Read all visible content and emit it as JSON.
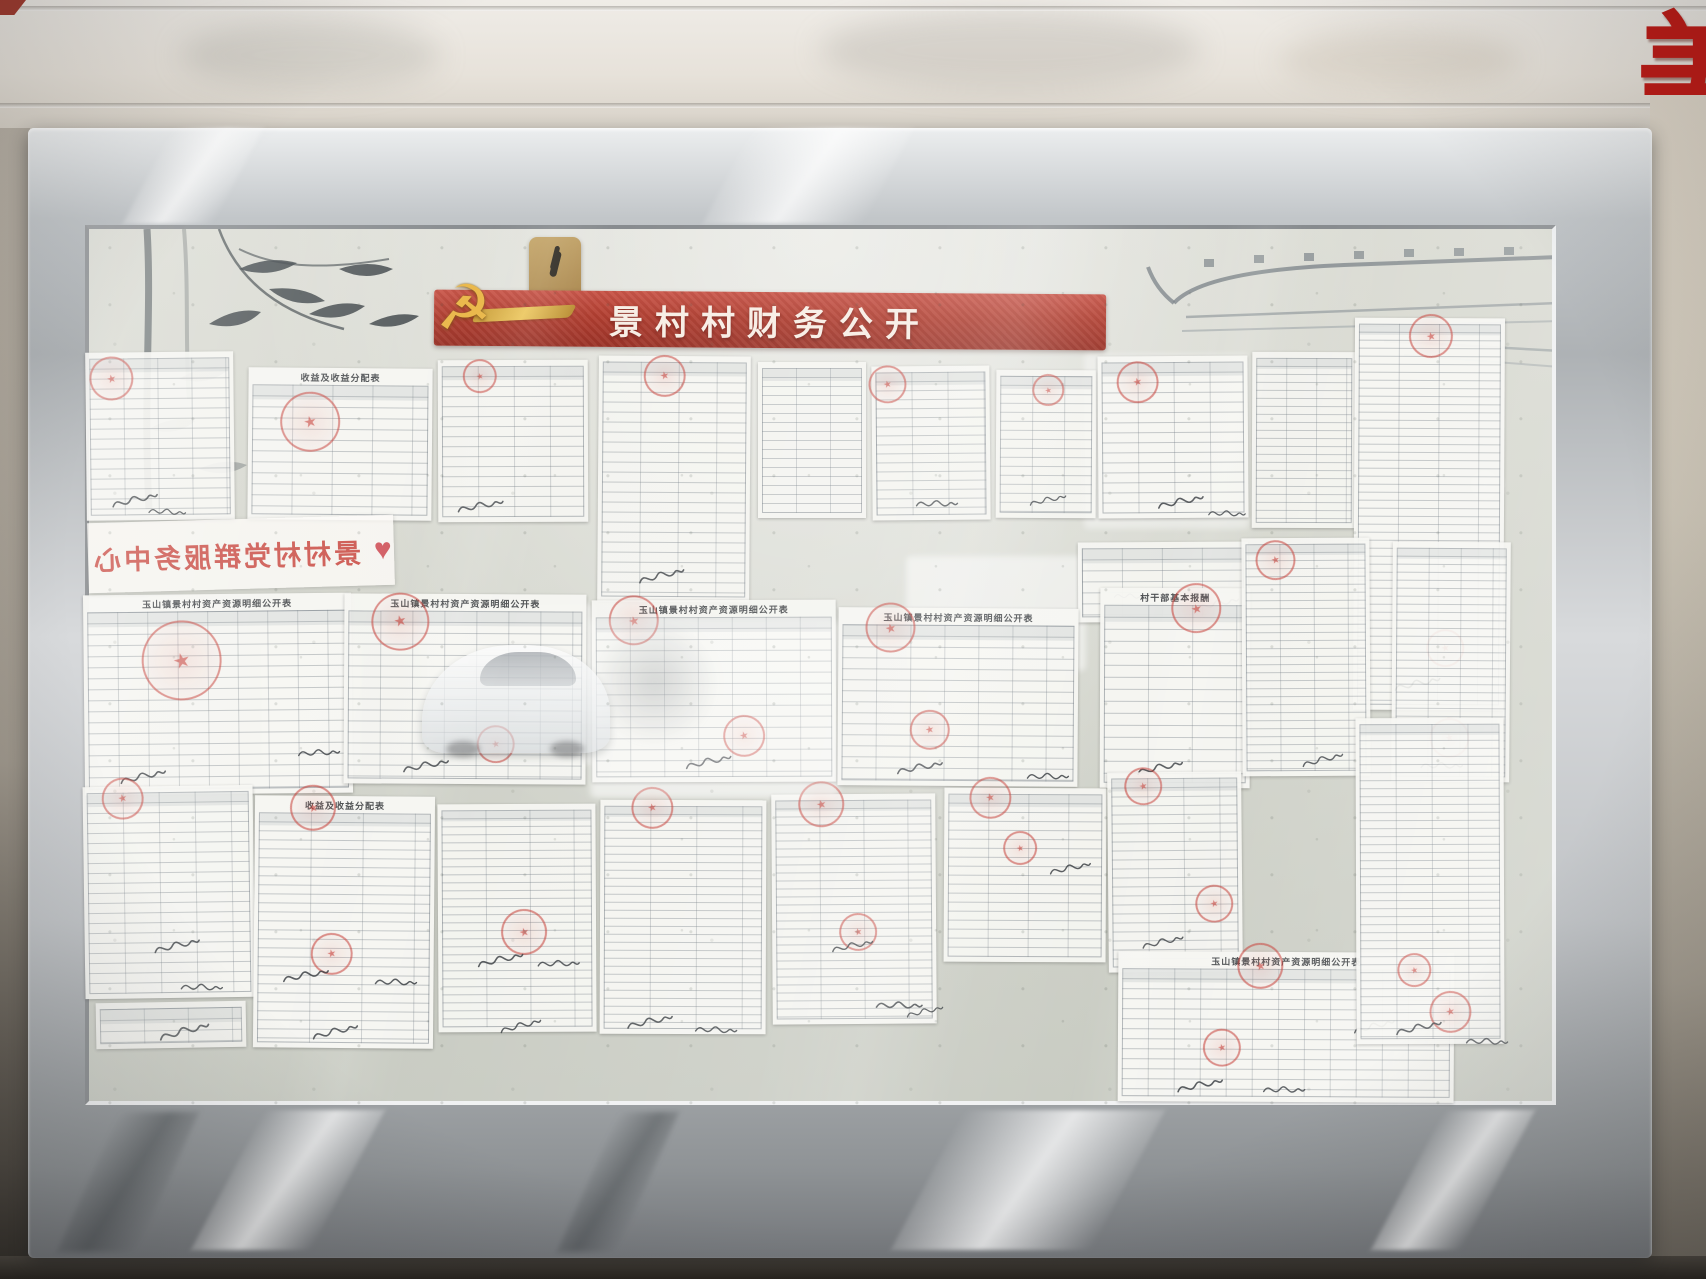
{
  "scene": {
    "banner_title": "景村村财务公开",
    "service_center_text": "景村村党群服务中心",
    "corner_sign_char": "美"
  },
  "colors": {
    "banner_red": "#b03a2c",
    "stamp_red": "#c32d26",
    "emblem_gold": "#e9b646",
    "frame_silver": "#c6c9cb",
    "glass_tint": "#d6d8cf"
  },
  "documents": [
    {
      "x": 86,
      "y": 352,
      "w": 148,
      "h": 168,
      "rot": -0.6,
      "rh": 10,
      "cw": 34,
      "op": 0.92,
      "title": "",
      "stamps": [
        [
          26,
          26,
          22
        ]
      ],
      "sigs": [
        [
          24,
          138,
          1,
          -6
        ],
        [
          56,
          150,
          0.8,
          10
        ]
      ]
    },
    {
      "x": 248,
      "y": 368,
      "w": 184,
      "h": 152,
      "rot": 0.5,
      "rh": 11,
      "cw": 40,
      "op": 0.95,
      "title": "收益及收益分配表",
      "stamps": [
        [
          62,
          54,
          30
        ]
      ],
      "sigs": []
    },
    {
      "x": 438,
      "y": 360,
      "w": 150,
      "h": 162,
      "rot": -0.2,
      "rh": 10,
      "cw": 36,
      "op": 0.9,
      "title": "",
      "stamps": [
        [
          42,
          16,
          17
        ]
      ],
      "sigs": [
        [
          18,
          136,
          1,
          -4
        ]
      ]
    },
    {
      "x": 598,
      "y": 356,
      "w": 152,
      "h": 246,
      "rot": 0.4,
      "rh": 10,
      "cw": 38,
      "op": 0.9,
      "title": "",
      "stamps": [
        [
          66,
          20,
          21
        ]
      ],
      "sigs": [
        [
          40,
          210,
          1,
          -8
        ]
      ]
    },
    {
      "x": 758,
      "y": 362,
      "w": 108,
      "h": 156,
      "rot": 0,
      "rh": 9,
      "cw": 34,
      "op": 0.88,
      "title": "",
      "stamps": [],
      "sigs": []
    },
    {
      "x": 872,
      "y": 366,
      "w": 118,
      "h": 154,
      "rot": -0.5,
      "rh": 9,
      "cw": 36,
      "op": 0.9,
      "title": "",
      "stamps": [
        [
          16,
          18,
          19
        ]
      ],
      "sigs": [
        [
          40,
          128,
          0.9,
          6
        ]
      ]
    },
    {
      "x": 996,
      "y": 370,
      "w": 100,
      "h": 148,
      "rot": 0.3,
      "rh": 9,
      "cw": 32,
      "op": 0.88,
      "title": "",
      "stamps": [
        [
          52,
          20,
          16
        ]
      ],
      "sigs": [
        [
          28,
          120,
          0.8,
          -6
        ]
      ]
    },
    {
      "x": 1098,
      "y": 356,
      "w": 150,
      "h": 162,
      "rot": -0.4,
      "rh": 10,
      "cw": 36,
      "op": 0.93,
      "title": "",
      "stamps": [
        [
          40,
          26,
          21
        ]
      ],
      "sigs": [
        [
          58,
          136,
          1,
          -5
        ],
        [
          104,
          148,
          0.8,
          8
        ]
      ]
    },
    {
      "x": 1252,
      "y": 352,
      "w": 104,
      "h": 176,
      "rot": 0.2,
      "rh": 8,
      "cw": 30,
      "op": 0.88,
      "title": "",
      "stamps": [],
      "sigs": []
    },
    {
      "x": 1354,
      "y": 318,
      "w": 150,
      "h": 392,
      "rot": 0.3,
      "rh": 8,
      "cw": 40,
      "op": 0.95,
      "title": "",
      "stamps": [
        [
          76,
          18,
          22
        ],
        [
          92,
          330,
          19
        ]
      ],
      "sigs": [
        [
          40,
          356,
          1,
          -6
        ]
      ]
    },
    {
      "x": 1078,
      "y": 542,
      "w": 170,
      "h": 80,
      "rot": -0.3,
      "rh": 11,
      "cw": 40,
      "op": 0.9,
      "title": "",
      "stamps": [],
      "sigs": [
        [
          116,
          52,
          0.9,
          -5
        ],
        [
          28,
          44,
          0.7,
          8
        ]
      ]
    },
    {
      "x": 1100,
      "y": 588,
      "w": 150,
      "h": 200,
      "rot": 0.2,
      "rh": 12,
      "cw": 44,
      "op": 0.96,
      "title": "村干部基本报酬",
      "stamps": [
        [
          96,
          20,
          25
        ]
      ],
      "sigs": [
        [
          36,
          170,
          1,
          -6
        ]
      ]
    },
    {
      "x": 1242,
      "y": 538,
      "w": 128,
      "h": 238,
      "rot": -0.3,
      "rh": 8,
      "cw": 34,
      "op": 0.92,
      "title": "",
      "stamps": [
        [
          34,
          22,
          20
        ]
      ],
      "sigs": [
        [
          56,
          212,
          0.9,
          -8
        ]
      ]
    },
    {
      "x": 1392,
      "y": 542,
      "w": 118,
      "h": 240,
      "rot": 0.4,
      "rh": 8,
      "cw": 32,
      "op": 0.9,
      "title": "",
      "stamps": [
        [
          58,
          196,
          20
        ]
      ],
      "sigs": [
        [
          26,
          214,
          0.9,
          6
        ]
      ]
    },
    {
      "x": 84,
      "y": 594,
      "w": 268,
      "h": 200,
      "rot": -0.6,
      "rh": 11,
      "cw": 30,
      "op": 0.96,
      "title": "玉山镇景村村资产资源明细公开表",
      "stamps": [
        [
          98,
          66,
          40
        ]
      ],
      "sigs": [
        [
          34,
          172,
          1,
          -6
        ],
        [
          210,
          150,
          0.9,
          4
        ]
      ]
    },
    {
      "x": 344,
      "y": 594,
      "w": 242,
      "h": 190,
      "rot": 0.3,
      "rh": 11,
      "cw": 32,
      "op": 0.94,
      "title": "玉山镇景村村资产资源明细公开表",
      "stamps": [
        [
          56,
          28,
          29
        ],
        [
          152,
          150,
          19
        ]
      ],
      "sigs": [
        [
          58,
          162,
          1,
          -5
        ]
      ]
    },
    {
      "x": 592,
      "y": 600,
      "w": 244,
      "h": 182,
      "rot": -0.2,
      "rh": 11,
      "cw": 34,
      "op": 0.92,
      "title": "玉山镇景村村资产资源明细公开表",
      "stamps": [
        [
          42,
          20,
          25
        ],
        [
          152,
          136,
          21
        ]
      ],
      "sigs": [
        [
          92,
          152,
          1,
          -6
        ]
      ]
    },
    {
      "x": 838,
      "y": 608,
      "w": 240,
      "h": 178,
      "rot": 0.4,
      "rh": 11,
      "cw": 34,
      "op": 0.94,
      "title": "玉山镇景村村资产资源明细公开表",
      "stamps": [
        [
          52,
          20,
          25
        ],
        [
          92,
          122,
          20
        ]
      ],
      "sigs": [
        [
          58,
          150,
          1,
          -5
        ],
        [
          186,
          158,
          0.9,
          6
        ]
      ]
    },
    {
      "x": 84,
      "y": 786,
      "w": 170,
      "h": 212,
      "rot": -0.8,
      "rh": 10,
      "cw": 36,
      "op": 0.95,
      "title": "",
      "stamps": [
        [
          40,
          12,
          21
        ]
      ],
      "sigs": [
        [
          68,
          150,
          1,
          -6
        ],
        [
          92,
          192,
          0.9,
          8
        ]
      ]
    },
    {
      "x": 96,
      "y": 1002,
      "w": 150,
      "h": 46,
      "rot": -1,
      "rh": 11,
      "cw": 44,
      "op": 0.85,
      "title": "",
      "stamps": [],
      "sigs": [
        [
          64,
          20,
          1.1,
          -8
        ]
      ]
    },
    {
      "x": 254,
      "y": 796,
      "w": 180,
      "h": 252,
      "rot": 0.5,
      "rh": 9,
      "cw": 52,
      "op": 0.97,
      "title": "收益及收益分配表",
      "stamps": [
        [
          58,
          12,
          23
        ],
        [
          78,
          158,
          21
        ]
      ],
      "sigs": [
        [
          28,
          170,
          1,
          -5
        ],
        [
          118,
          176,
          0.9,
          7
        ],
        [
          58,
          226,
          1,
          -8
        ]
      ]
    },
    {
      "x": 438,
      "y": 804,
      "w": 158,
      "h": 228,
      "rot": -0.3,
      "rh": 8,
      "cw": 44,
      "op": 0.93,
      "title": "",
      "stamps": [
        [
          86,
          128,
          23
        ]
      ],
      "sigs": [
        [
          38,
          146,
          1,
          -6
        ],
        [
          96,
          150,
          0.9,
          5
        ],
        [
          58,
          212,
          0.9,
          -8
        ]
      ]
    },
    {
      "x": 600,
      "y": 800,
      "w": 166,
      "h": 234,
      "rot": 0.2,
      "rh": 8,
      "cw": 46,
      "op": 0.94,
      "title": "",
      "stamps": [
        [
          52,
          8,
          21
        ]
      ],
      "sigs": [
        [
          26,
          212,
          1,
          -6
        ],
        [
          92,
          220,
          0.9,
          8
        ]
      ]
    },
    {
      "x": 772,
      "y": 794,
      "w": 164,
      "h": 230,
      "rot": -0.4,
      "rh": 8,
      "cw": 44,
      "op": 0.94,
      "title": "",
      "stamps": [
        [
          50,
          10,
          23
        ],
        [
          86,
          138,
          19
        ]
      ],
      "sigs": [
        [
          56,
          142,
          0.9,
          -5
        ],
        [
          102,
          202,
          1,
          7
        ],
        [
          128,
          208,
          0.8,
          -6
        ]
      ]
    },
    {
      "x": 944,
      "y": 788,
      "w": 162,
      "h": 174,
      "rot": 0.3,
      "rh": 9,
      "cw": 40,
      "op": 0.93,
      "title": "",
      "stamps": [
        [
          46,
          10,
          21
        ],
        [
          76,
          60,
          17
        ]
      ],
      "sigs": [
        [
          102,
          70,
          0.9,
          -6
        ]
      ]
    },
    {
      "x": 1108,
      "y": 772,
      "w": 134,
      "h": 200,
      "rot": -0.5,
      "rh": 9,
      "cw": 36,
      "op": 0.92,
      "title": "",
      "stamps": [
        [
          36,
          14,
          19
        ],
        [
          106,
          132,
          19
        ]
      ],
      "sigs": [
        [
          30,
          160,
          0.9,
          -6
        ]
      ]
    },
    {
      "x": 1118,
      "y": 952,
      "w": 336,
      "h": 150,
      "rot": 0.3,
      "rh": 10,
      "cw": 26,
      "op": 0.96,
      "title": "玉山镇景村村资产资源明细公开表",
      "stamps": [
        [
          142,
          14,
          23
        ],
        [
          104,
          96,
          19
        ]
      ],
      "sigs": [
        [
          58,
          124,
          1,
          -6
        ],
        [
          142,
          128,
          0.9,
          6
        ],
        [
          232,
          64,
          0.9,
          -8
        ]
      ]
    },
    {
      "x": 1356,
      "y": 718,
      "w": 148,
      "h": 326,
      "rot": -0.2,
      "rh": 8,
      "cw": 36,
      "op": 0.94,
      "title": "",
      "stamps": [
        [
          94,
          294,
          21
        ],
        [
          58,
          252,
          17
        ]
      ],
      "sigs": [
        [
          38,
          300,
          1,
          -6
        ],
        [
          106,
          314,
          0.9,
          8
        ]
      ]
    }
  ]
}
